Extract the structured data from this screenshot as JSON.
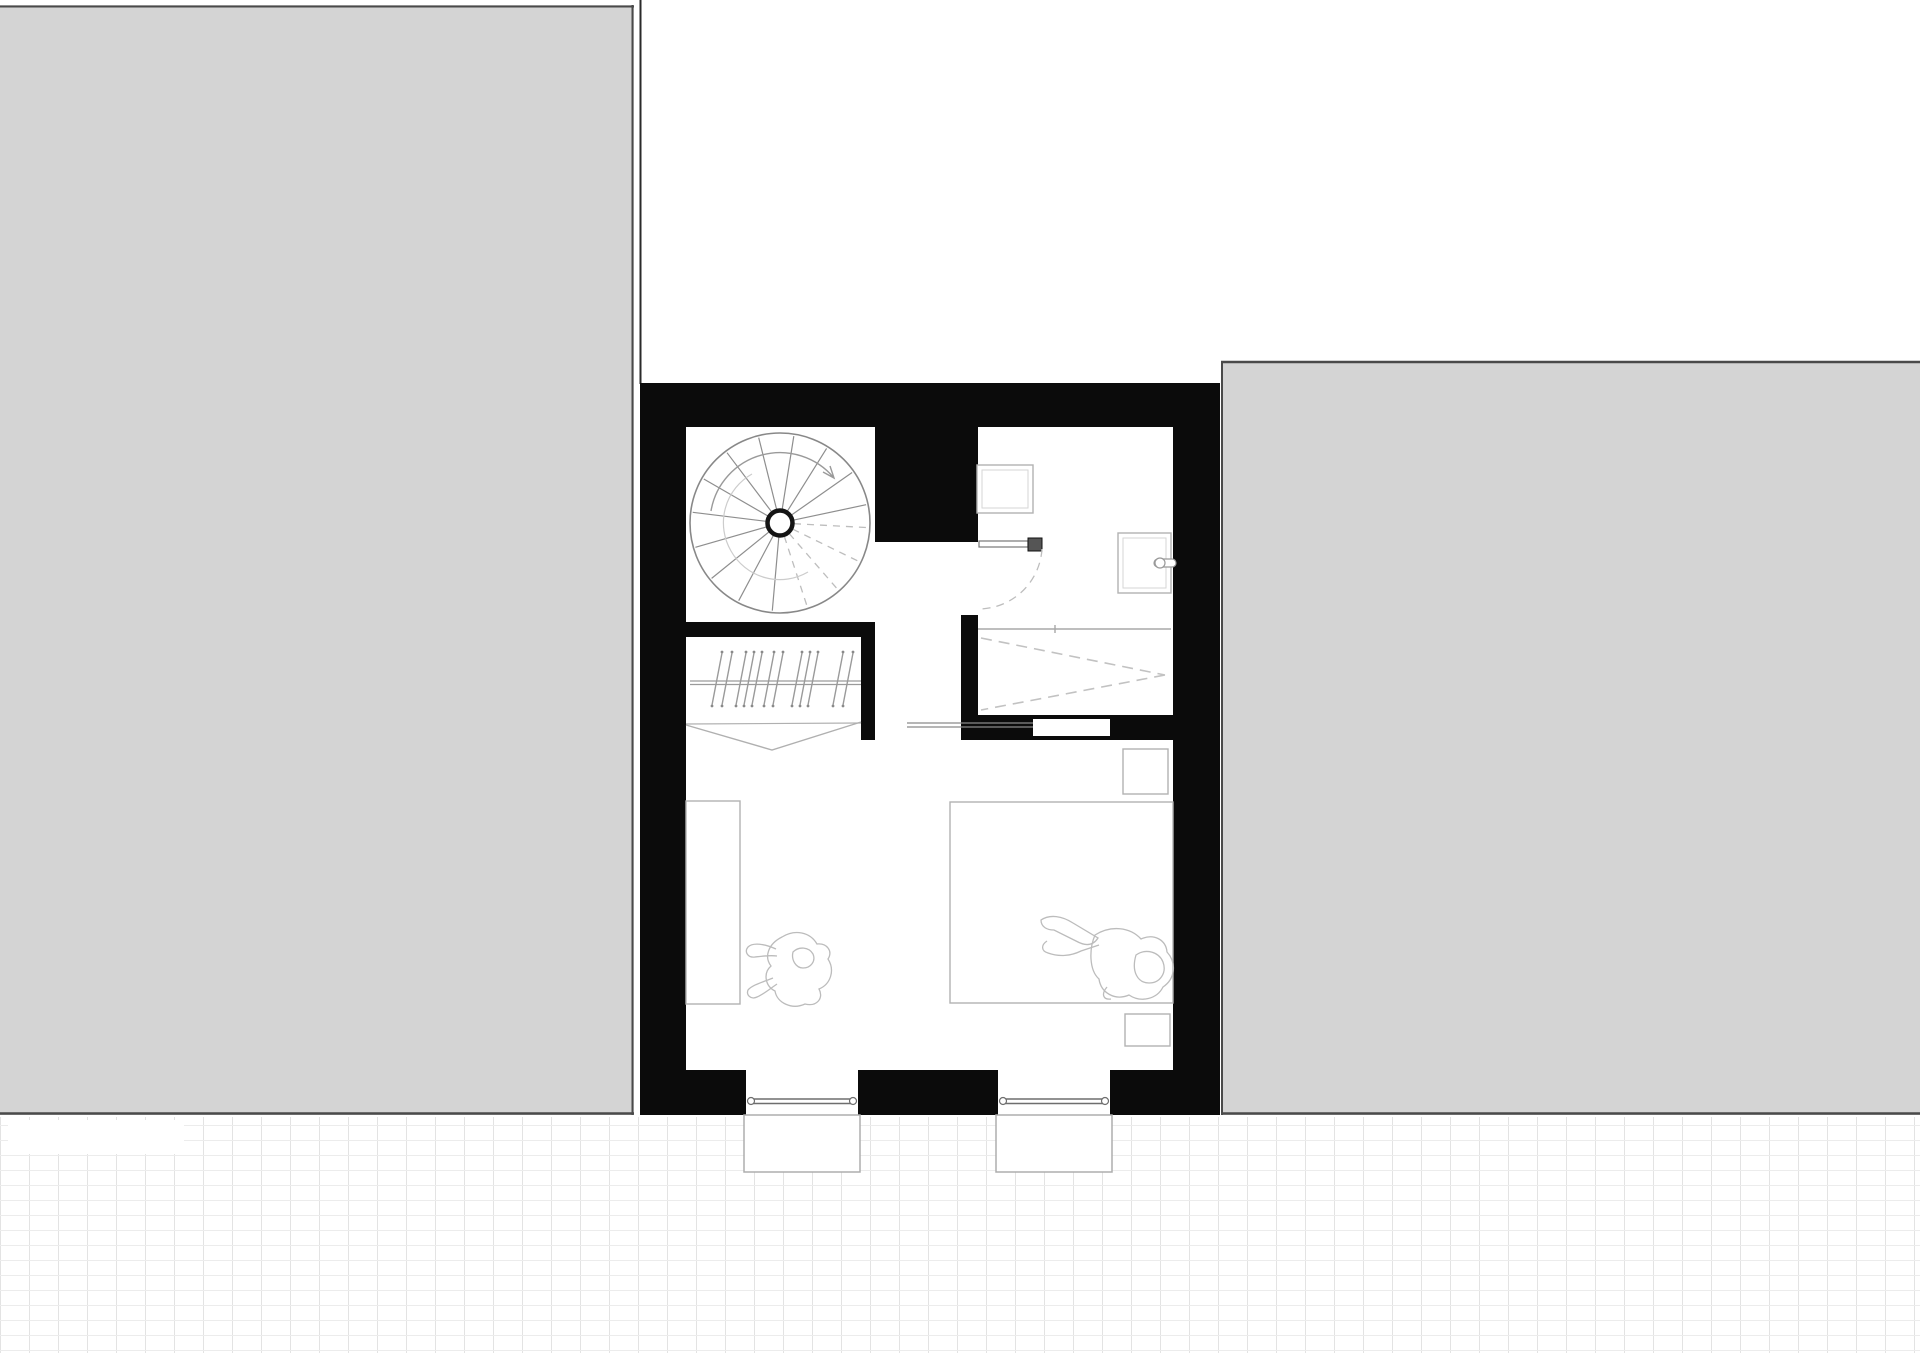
{
  "page": {
    "title": "Floor Plan",
    "background": "#ffffff"
  },
  "canvas": {
    "width": 1920,
    "height": 1353
  },
  "colors": {
    "wall": "#0b0b0b",
    "neighbor_fill": "#d4d4d4",
    "neighbor_border": "#4a4a4a",
    "furniture_line": "#b2b2b2",
    "furniture_inner_line": "#d6d6d6",
    "stair_line": "#8e8e8e",
    "dashed_line": "#bdbdbd",
    "glass_line": "#6e6e6e",
    "door_line": "#8a8a8a",
    "figure_line": "#bcbcbc",
    "tile_v_line": "#e3e3e3",
    "tile_h_line": "#ececec"
  },
  "paving": {
    "x": 0,
    "y": 1117,
    "width": 1920,
    "height": 236,
    "tile_w": 29,
    "tile_h": 15,
    "v_line": "#e3e3e3",
    "h_line": "#ececec"
  },
  "plan": {
    "elements": [
      {
        "name": "neighbor-left-building",
        "kind": "rect",
        "a": {
          "x": 0,
          "y": 5,
          "width": 634,
          "height": 1110,
          "fill": "#d4d4d4"
        }
      },
      {
        "name": "neighbor-left-border-top",
        "kind": "line",
        "a": {
          "x1": 0,
          "y1": 6.5,
          "x2": 634,
          "y2": 6.5,
          "stroke": "#4a4a4a",
          "stroke-width": 2
        }
      },
      {
        "name": "neighbor-left-border-right",
        "kind": "line",
        "a": {
          "x1": 632.5,
          "y1": 5,
          "x2": 632.5,
          "y2": 1115,
          "stroke": "#4a4a4a",
          "stroke-width": 2
        }
      },
      {
        "name": "neighbor-left-border-bottom",
        "kind": "line",
        "a": {
          "x1": 0,
          "y1": 1113.5,
          "x2": 634,
          "y2": 1113.5,
          "stroke": "#4a4a4a",
          "stroke-width": 2.5
        }
      },
      {
        "name": "neighbor-right-building",
        "kind": "rect",
        "a": {
          "x": 1221,
          "y": 361,
          "width": 699,
          "height": 754,
          "fill": "#d4d4d4"
        }
      },
      {
        "name": "neighbor-right-border-top",
        "kind": "line",
        "a": {
          "x1": 1221,
          "y1": 362,
          "x2": 1920,
          "y2": 362,
          "stroke": "#4a4a4a",
          "stroke-width": 2.5
        }
      },
      {
        "name": "neighbor-right-border-left",
        "kind": "line",
        "a": {
          "x1": 1222,
          "y1": 361,
          "x2": 1222,
          "y2": 1115,
          "stroke": "#4a4a4a",
          "stroke-width": 2
        }
      },
      {
        "name": "neighbor-right-border-bottom",
        "kind": "line",
        "a": {
          "x1": 1221,
          "y1": 1113.5,
          "x2": 1920,
          "y2": 1113.5,
          "stroke": "#4a4a4a",
          "stroke-width": 2.5
        }
      },
      {
        "name": "site-boundary-line",
        "kind": "line",
        "a": {
          "x1": 640.5,
          "y1": 0,
          "x2": 640.5,
          "y2": 384,
          "stroke": "#2a2a2a",
          "stroke-width": 2
        }
      },
      {
        "name": "paving-area",
        "kind": "rect",
        "a": {
          "x": 0,
          "y": 1117,
          "width": 1920,
          "height": 236,
          "fill": "url(#tiles)"
        }
      },
      {
        "name": "paving-blank-patch",
        "kind": "rect",
        "a": {
          "x": 8,
          "y": 1120,
          "width": 176,
          "height": 34,
          "fill": "#ffffff"
        }
      },
      {
        "name": "building-mass",
        "kind": "rect",
        "a": {
          "x": 640,
          "y": 383,
          "width": 580,
          "height": 732,
          "fill": "#0b0b0b"
        }
      },
      {
        "name": "room-stairwell",
        "kind": "rect",
        "a": {
          "x": 686,
          "y": 427,
          "width": 189,
          "height": 195,
          "fill": "#ffffff"
        }
      },
      {
        "name": "room-wardrobe",
        "kind": "rect",
        "a": {
          "x": 686,
          "y": 637,
          "width": 175,
          "height": 103,
          "fill": "#ffffff"
        }
      },
      {
        "name": "room-corridor",
        "kind": "rect",
        "a": {
          "x": 875,
          "y": 542,
          "width": 86,
          "height": 198,
          "fill": "#ffffff"
        }
      },
      {
        "name": "bathroom-door-opening",
        "kind": "rect",
        "a": {
          "x": 961,
          "y": 542,
          "width": 17,
          "height": 73,
          "fill": "#ffffff"
        }
      },
      {
        "name": "room-bathroom",
        "kind": "rect",
        "a": {
          "x": 978,
          "y": 427,
          "width": 195,
          "height": 288,
          "fill": "#ffffff"
        }
      },
      {
        "name": "room-bedroom",
        "kind": "rect",
        "a": {
          "x": 686,
          "y": 740,
          "width": 487,
          "height": 330,
          "fill": "#ffffff"
        }
      },
      {
        "name": "window-1-opening",
        "kind": "rect",
        "a": {
          "x": 746,
          "y": 1070,
          "width": 112,
          "height": 45,
          "fill": "#ffffff"
        }
      },
      {
        "name": "window-2-opening",
        "kind": "rect",
        "a": {
          "x": 998,
          "y": 1070,
          "width": 112,
          "height": 45,
          "fill": "#ffffff"
        }
      },
      {
        "name": "sliding-door-slot",
        "kind": "rect",
        "a": {
          "x": 1033,
          "y": 719,
          "width": 77,
          "height": 17,
          "fill": "#ffffff"
        }
      },
      {
        "name": "window-1-sill",
        "kind": "rect",
        "a": {
          "x": 744,
          "y": 1115,
          "width": 116,
          "height": 57,
          "fill": "#ffffff",
          "stroke": "#adadad",
          "stroke-width": 1.5
        }
      },
      {
        "name": "window-2-sill",
        "kind": "rect",
        "a": {
          "x": 996,
          "y": 1115,
          "width": 116,
          "height": 57,
          "fill": "#ffffff",
          "stroke": "#adadad",
          "stroke-width": 1.5
        }
      },
      {
        "name": "window-1-glass",
        "kind": "path",
        "a": {
          "d": "M752 1099 H852 M752 1103.5 H852",
          "stroke": "#6e6e6e",
          "stroke-width": 1.4,
          "fill": "none"
        }
      },
      {
        "name": "window-1-glass-end-left",
        "kind": "circle",
        "a": {
          "cx": 751,
          "cy": 1101,
          "r": 3.5,
          "fill": "#ffffff",
          "stroke": "#6e6e6e",
          "stroke-width": 1.2
        }
      },
      {
        "name": "window-1-glass-end-right",
        "kind": "circle",
        "a": {
          "cx": 853,
          "cy": 1101,
          "r": 3.5,
          "fill": "#ffffff",
          "stroke": "#6e6e6e",
          "stroke-width": 1.2
        }
      },
      {
        "name": "window-2-glass",
        "kind": "path",
        "a": {
          "d": "M1004 1099 H1104 M1004 1103.5 H1104",
          "stroke": "#6e6e6e",
          "stroke-width": 1.4,
          "fill": "none"
        }
      },
      {
        "name": "window-2-glass-end-left",
        "kind": "circle",
        "a": {
          "cx": 1003,
          "cy": 1101,
          "r": 3.5,
          "fill": "#ffffff",
          "stroke": "#6e6e6e",
          "stroke-width": 1.2
        }
      },
      {
        "name": "window-2-glass-end-right",
        "kind": "circle",
        "a": {
          "cx": 1105,
          "cy": 1101,
          "r": 3.5,
          "fill": "#ffffff",
          "stroke": "#6e6e6e",
          "stroke-width": 1.2
        }
      },
      {
        "name": "spiral-stair-outline",
        "kind": "circle",
        "a": {
          "cx": 780,
          "cy": 523,
          "r": 90,
          "fill": "#ffffff",
          "stroke": "#888888",
          "stroke-width": 1.6
        }
      },
      {
        "name": "spiral-stair-treads",
        "kind": "path",
        "a": {
          "d": "M793.7 520.1 L866.1 504.7 M791.5 515 L852.1 472.5 M787.4 511.1 L826.6 448.4 M782.2 509.2 L793.8 436.1 M776.6 509.4 L758.7 437.6 M771.6 511.8 L727 452.7 M767.9 516 L703.8 479 M766.1 521.3 L692.7 512.3 M766.5 526.9 L695.4 547.3 M769.1 531.8 L711.6 578.4 M773.4 535.4 L738.7 600.7 M778.8 536.9 L772.3 610.7",
          "stroke": "#8e8e8e",
          "stroke-width": 1.2,
          "fill": "none"
        }
      },
      {
        "name": "spiral-stair-treads-dashed",
        "kind": "path",
        "a": {
          "d": "M784.3 536.3 L806.6 604.8 M789.2 533.6 L836.4 587.9 M792.6 529.1 L857.3 560.7 M794 523.7 L865.9 527.5",
          "stroke": "#bdbdbd",
          "stroke-width": 1.3,
          "stroke-dasharray": "7,6",
          "fill": "none"
        }
      },
      {
        "name": "spiral-stair-inner-arc",
        "kind": "path",
        "a": {
          "d": "M752 474 A56 56 0 0 0 731 551 A56 56 0 0 0 808 572",
          "stroke": "#cccccc",
          "stroke-width": 1.2,
          "fill": "none"
        }
      },
      {
        "name": "spiral-stair-walk-line",
        "kind": "path",
        "a": {
          "d": "M711 511 A70 70 0 0 1 834 478 M830 466 L834 478 L823 472",
          "stroke": "#9a9a9a",
          "stroke-width": 1.4,
          "fill": "none"
        }
      },
      {
        "name": "spiral-stair-newel",
        "kind": "circle",
        "a": {
          "cx": 780,
          "cy": 523,
          "r": 12.5,
          "fill": "#ffffff",
          "stroke": "#141414",
          "stroke-width": 4.5
        }
      },
      {
        "name": "wardrobe-rail",
        "kind": "path",
        "a": {
          "d": "M690 681 H861 M690 684.5 H861",
          "stroke": "#9a9a9a",
          "stroke-width": 1.2,
          "fill": "none"
        }
      },
      {
        "name": "wardrobe-hangers",
        "kind": "path",
        "a": {
          "d": "M722 653 L712 705 M732 653 L722 705 M746 653 L736 705 M754 653 L744 705 M762 653 L752 705 M774 653 L764 705 M783 653 L773 705 M802 653 L792 705 M810 653 L800 705 M818 653 L808 705 M843 653 L833 705 M853 653 L843 705",
          "stroke": "#9a9a9a",
          "stroke-width": 1.4,
          "fill": "none"
        }
      },
      {
        "name": "wardrobe-hanger-hooks",
        "kind": "path",
        "a": {
          "d": "M722 652 l0.01 0 M732 652 l0.01 0 M746 652 l0.01 0 M754 652 l0.01 0 M762 652 l0.01 0 M774 652 l0.01 0 M783 652 l0.01 0 M802 652 l0.01 0 M810 652 l0.01 0 M818 652 l0.01 0 M843 652 l0.01 0 M853 652 l0.01 0 M712 706 l0.01 0 M722 706 l0.01 0 M736 706 l0.01 0 M744 706 l0.01 0 M752 706 l0.01 0 M764 706 l0.01 0 M773 706 l0.01 0 M792 706 l0.01 0 M800 706 l0.01 0 M808 706 l0.01 0 M833 706 l0.01 0 M843 706 l0.01 0",
          "stroke": "#8a8a8a",
          "stroke-width": 2.8,
          "stroke-linecap": "round",
          "fill": "none"
        }
      },
      {
        "name": "wardrobe-curtain-line",
        "kind": "line",
        "a": {
          "x1": 686,
          "y1": 724,
          "x2": 861,
          "y2": 723,
          "stroke": "#b0b0b0",
          "stroke-width": 1.2
        }
      },
      {
        "name": "wardrobe-curtain",
        "kind": "polyline",
        "a": {
          "points": "686,725 772,750 861,722",
          "stroke": "#b0b0b0",
          "stroke-width": 1.4,
          "fill": "none"
        }
      },
      {
        "name": "sliding-door-panel",
        "kind": "path",
        "a": {
          "d": "M907 723 H1033 M907 727 H1033",
          "stroke": "#8a8a8a",
          "stroke-width": 1.3,
          "fill": "none"
        }
      },
      {
        "name": "bathroom-fixture",
        "kind": "rect",
        "a": {
          "x": 977,
          "y": 465,
          "width": 56,
          "height": 48,
          "fill": "#ffffff",
          "stroke": "#b2b2b2",
          "stroke-width": 1.4
        }
      },
      {
        "name": "bathroom-fixture-inner",
        "kind": "rect",
        "a": {
          "x": 982,
          "y": 470,
          "width": 46,
          "height": 38,
          "fill": "none",
          "stroke": "#d6d6d6",
          "stroke-width": 1
        }
      },
      {
        "name": "washbasin",
        "kind": "rect",
        "a": {
          "x": 1118,
          "y": 533,
          "width": 53,
          "height": 60,
          "fill": "#ffffff",
          "stroke": "#b2b2b2",
          "stroke-width": 1.4
        }
      },
      {
        "name": "washbasin-inner",
        "kind": "rect",
        "a": {
          "x": 1123,
          "y": 538,
          "width": 43,
          "height": 50,
          "fill": "none",
          "stroke": "#d6d6d6",
          "stroke-width": 1
        }
      },
      {
        "name": "washbasin-tap-bar",
        "kind": "rect",
        "a": {
          "x": 1154,
          "y": 559,
          "width": 22,
          "height": 8,
          "rx": 4,
          "fill": "#ffffff",
          "stroke": "#999999",
          "stroke-width": 1.2
        }
      },
      {
        "name": "washbasin-tap-knob",
        "kind": "circle",
        "a": {
          "cx": 1160,
          "cy": 563,
          "r": 5,
          "fill": "#ffffff",
          "stroke": "#999999",
          "stroke-width": 1.2
        }
      },
      {
        "name": "shower-threshold",
        "kind": "path",
        "a": {
          "d": "M978 629 H1171 M1055 625 V633",
          "stroke": "#a8a8a8",
          "stroke-width": 1.4,
          "fill": "none"
        }
      },
      {
        "name": "shower-slope-dashes",
        "kind": "path",
        "a": {
          "d": "M981 638 L1165 675 M1165 675 L981 710",
          "stroke": "#c2c2c2",
          "stroke-width": 1.6,
          "stroke-dasharray": "11,7",
          "fill": "none"
        }
      },
      {
        "name": "bathroom-door-leaf",
        "kind": "rect",
        "a": {
          "x": 979,
          "y": 541,
          "width": 49,
          "height": 6,
          "fill": "#ffffff",
          "stroke": "#777777",
          "stroke-width": 1.2
        }
      },
      {
        "name": "bathroom-door-handle",
        "kind": "rect",
        "a": {
          "x": 1028,
          "y": 538,
          "width": 14,
          "height": 13,
          "fill": "#555555",
          "stroke": "#111111",
          "stroke-width": 1
        }
      },
      {
        "name": "bathroom-door-swing",
        "kind": "path",
        "a": {
          "d": "M1042 549 A64 64 0 0 1 978 609",
          "stroke": "#bdbdbd",
          "stroke-width": 1.3,
          "stroke-dasharray": "8,6",
          "fill": "none"
        }
      },
      {
        "name": "bedroom-desk",
        "kind": "rect",
        "a": {
          "x": 686,
          "y": 801,
          "width": 54,
          "height": 203,
          "fill": "#ffffff",
          "stroke": "#b2b2b2",
          "stroke-width": 1.4
        }
      },
      {
        "name": "double-bed",
        "kind": "rect",
        "a": {
          "x": 950,
          "y": 802,
          "width": 223,
          "height": 201,
          "fill": "#ffffff",
          "stroke": "#b2b2b2",
          "stroke-width": 1.4
        }
      },
      {
        "name": "nightstand-top",
        "kind": "rect",
        "a": {
          "x": 1123,
          "y": 749,
          "width": 45,
          "height": 45,
          "fill": "#ffffff",
          "stroke": "#b2b2b2",
          "stroke-width": 1.4
        }
      },
      {
        "name": "nightstand-bottom",
        "kind": "rect",
        "a": {
          "x": 1125,
          "y": 1014,
          "width": 45,
          "height": 32,
          "fill": "#ffffff",
          "stroke": "#b2b2b2",
          "stroke-width": 1.4
        }
      },
      {
        "name": "figure-sitting-person",
        "kind": "path",
        "a": {
          "d": "M782 937 C795 929 810 932 817 944 C827 943 833 951 828 959 C835 970 831 984 819 989 C824 998 817 1007 805 1004 C792 1010 777 1003 775 991 C765 986 763 973 771 966 C764 957 768 944 782 937 Z M776 949 C765 944 753 942 748 947 C744 952 748 958 755 957 C763 956 770 955 777 956 M773 978 C763 982 752 985 748 990 C746 995 751 1000 757 997 C764 994 771 988 777 984 M793 952 C799 946 809 947 813 954 C816 961 811 968 803 968 C796 968 791 960 793 952 Z",
          "stroke": "#bcbcbc",
          "stroke-width": 1.3,
          "fill": "none"
        }
      },
      {
        "name": "figure-lying-person",
        "kind": "path",
        "a": {
          "d": "M1041 920 C1050 914 1062 916 1073 923 L1098 938 C1093 946 1085 946 1076 941 L1054 930 C1047 930 1041 927 1041 920 Z M1047 941 C1041 945 1041 951 1048 953 C1059 957 1071 956 1081 951 L1099 945 M1095 935 C1111 925 1130 927 1141 939 C1154 933 1166 940 1167 952 C1177 963 1175 979 1163 987 C1157 999 1141 1003 1129 995 C1115 1001 1101 993 1099 979 C1089 970 1089 949 1095 935 Z M1136 955 C1146 948 1159 952 1163 962 C1167 973 1160 983 1149 983 C1138 983 1131 972 1136 955 Z M1107 987 C1101 994 1103 1000 1111 999",
          "stroke": "#bcbcbc",
          "stroke-width": 1.3,
          "fill": "none"
        }
      }
    ]
  }
}
